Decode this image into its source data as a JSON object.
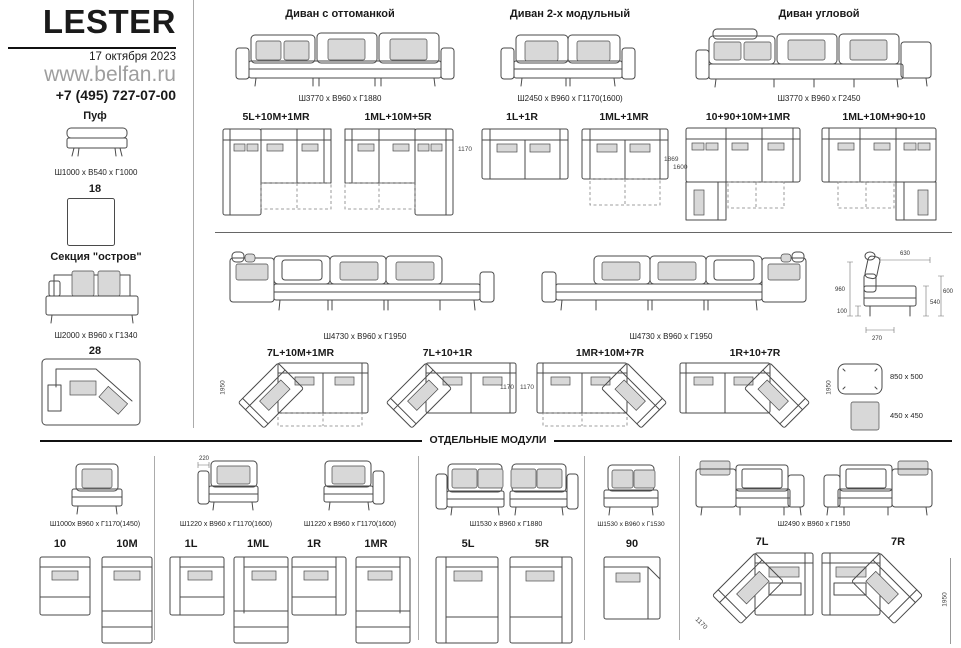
{
  "brand": {
    "title": "LESTER",
    "date": "17 октября 2023",
    "site": "www.belfan.ru",
    "phone": "+7 (495) 727-07-00"
  },
  "sidebar": {
    "pouf_label": "Пуф",
    "pouf_dims": "Ш1000 x В540 x Г1000",
    "pouf_code": "18",
    "island_label": "Секция \"остров\"",
    "island_dims": "Ш2000 x В960 x Г1340",
    "island_code": "28"
  },
  "sofas": [
    {
      "title": "Диван с оттоманкой",
      "dims": "Ш3770 x В960 x Г1880",
      "config_left": "5L+10M+1MR",
      "config_right": "1ML+10M+5R"
    },
    {
      "title": "Диван 2-х модульный",
      "dims": "Ш2450 x В960 x Г1170(1600)",
      "config_left": "1L+1R",
      "config_right": "1ML+1MR",
      "dim_left": "1170",
      "dim_right": "1600"
    },
    {
      "title": "Диван угловой",
      "dims": "Ш3770 x В960 x Г2450",
      "config_left": "10+90+10M+1MR",
      "config_right": "1ML+10M+90+10",
      "dim_left": "1869"
    }
  ],
  "long_sofas": [
    {
      "dims": "Ш4730 x В960 x Г1950",
      "config_left": "7L+10M+1MR",
      "config_right": "7L+10+1R",
      "dim_left": "1950",
      "dim_right": "1170"
    },
    {
      "dims": "Ш4730 x В960 x Г1950",
      "config_left": "1MR+10M+7R",
      "config_right": "1R+10+7R",
      "dim_left": "1170",
      "dim_right": "1950"
    }
  ],
  "side_view": {
    "top": "630",
    "height": "960",
    "leg": "100",
    "base": "270",
    "seat": "540",
    "arm": "600"
  },
  "pillows": {
    "rect": "850 x 500",
    "square": "450 x 450"
  },
  "modules": {
    "title": "ОТДЕЛЬНЫЕ МОДУЛИ",
    "groups": [
      {
        "dims": "Ш1000х В960 х Г1170(1450)",
        "label_a": "10",
        "label_b": "10M"
      },
      {
        "dims": "Ш1220 х В960 х Г1170(1600)",
        "label_a": "1L",
        "label_b": "1ML",
        "arm_dim": "220"
      },
      {
        "dims": "Ш1220 х В960 х Г1170(1600)",
        "label_a": "1R",
        "label_b": "1MR"
      },
      {
        "dims": "Ш1530 х В960 х Г1880",
        "label_a": "5L",
        "label_b": "5R"
      },
      {
        "dims": "Ш1530 х В960 х Г1530",
        "label_a": "90"
      },
      {
        "dims": "Ш2490 х В960 х Г1950",
        "label_a": "7L",
        "label_b": "7R",
        "dim_diag": "1170",
        "dim_side": "1950"
      }
    ]
  },
  "colors": {
    "line_art": "#4a4a4a",
    "cushion_fill": "#d8d8d8",
    "site_gray": "#9e9e9e"
  }
}
